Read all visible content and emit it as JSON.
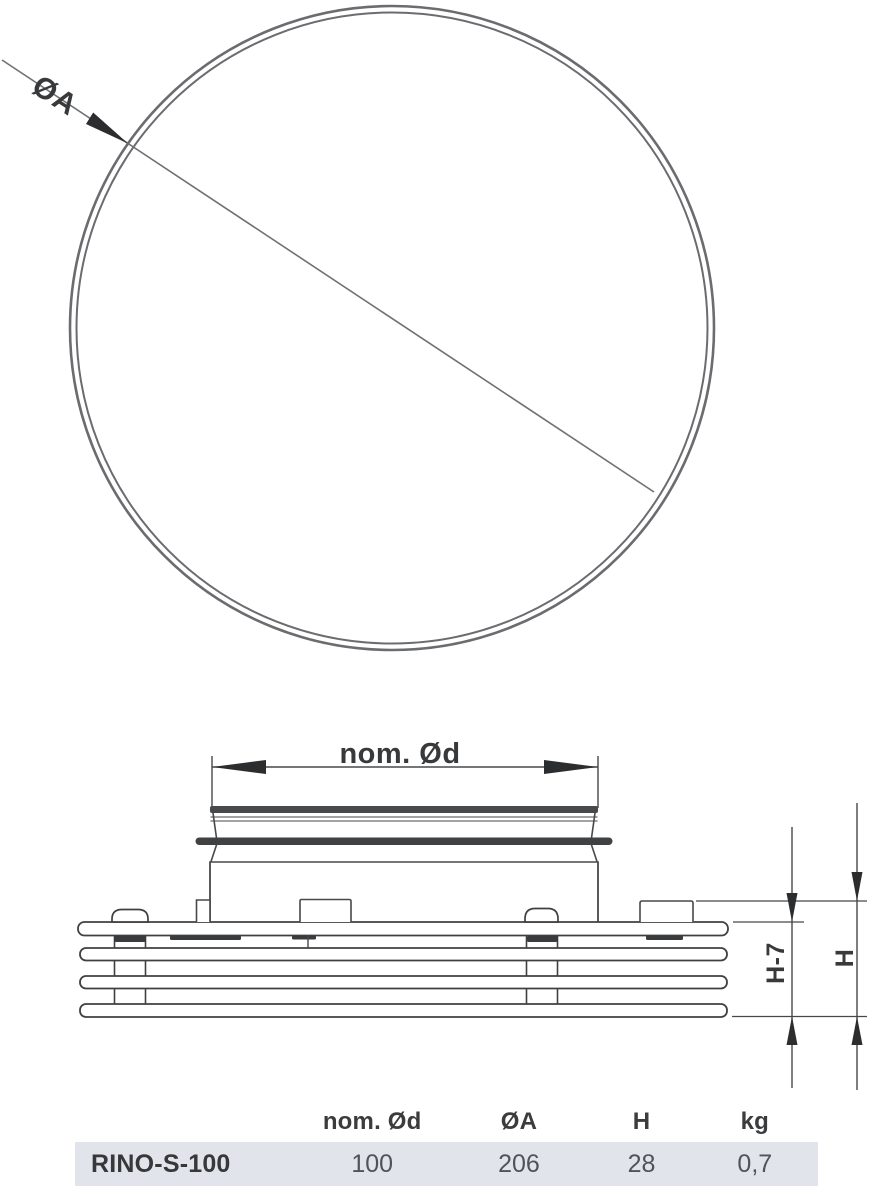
{
  "top_view": {
    "diameter_label": "ØA"
  },
  "side_view": {
    "nominal_diameter_label": "nom. Ød",
    "height_minus_7_label": "H-7",
    "height_label": "H"
  },
  "table": {
    "columns": [
      "",
      "nom. Ød",
      "ØA",
      "H",
      "kg"
    ],
    "row": {
      "model": "RINO-S-100",
      "nom_od": "100",
      "oa": "206",
      "h": "28",
      "kg": "0,7"
    }
  },
  "colors": {
    "row_background": "#e1e5eb",
    "drawing_line_gray": "#6b6c6f",
    "drawing_line_dark": "#47484a",
    "arrow_fill": "#2c2d2f",
    "text_dark": "#38393b",
    "text_value": "#505358"
  }
}
